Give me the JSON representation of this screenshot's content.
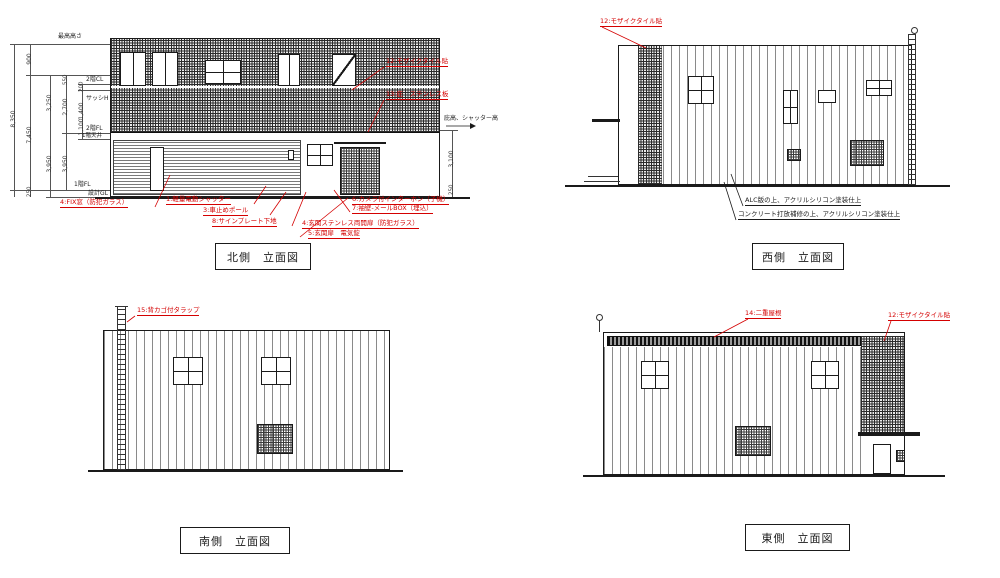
{
  "drawing": {
    "annotation_red": "#d40000",
    "line_black": "#1a1a1a"
  },
  "north": {
    "title": "北側　立面図",
    "levels": {
      "top": "最高高さ",
      "f2cl": "2階CL",
      "sash": "サッシH",
      "f2fl": "2階FL",
      "f1ceil": "1階天井",
      "f1fl": "1階FL",
      "gl": "設計GL",
      "hisashi": "庇高、シャッター高"
    },
    "dims": {
      "total": "8,350",
      "upper_total": "7,450",
      "parapet": "900",
      "f2_height": "3,250",
      "f2_ceiling": "2,700",
      "d550": "550",
      "d200": "200",
      "sash_h": "1,400",
      "d1100": "1,100",
      "f1_height_a": "3,950",
      "f1_height_b": "3,950",
      "base": "250",
      "right_height": "3,100",
      "right_base": "250"
    },
    "labels": [
      "12:モザイクタイル貼",
      "13:庇　ステンレス板",
      "4:FIX窓（防犯ガラス）",
      "1:軽量電動シャッター",
      "3:車止めポール",
      "8:サインプレート下地",
      "6:カメラ付インターホン（子機）",
      "7:袖壁-メールBOX（埋込）",
      "4:玄関ステンレス両開扉（防犯ガラス）",
      "5:玄関扉　電気錠"
    ]
  },
  "west": {
    "title": "西側　立面図",
    "labels": [
      "12:モザイクタイル貼"
    ],
    "notes": [
      "ALC版の上、アクリルシリコン塗装仕上",
      "コンクリート打放補修の上、アクリルシリコン塗装仕上"
    ]
  },
  "south": {
    "title": "南側　立面図",
    "labels": [
      "15:背カゴ付タラップ"
    ]
  },
  "east": {
    "title": "東側　立面図",
    "labels": [
      "14:二重屋根",
      "12:モザイクタイル貼"
    ]
  }
}
